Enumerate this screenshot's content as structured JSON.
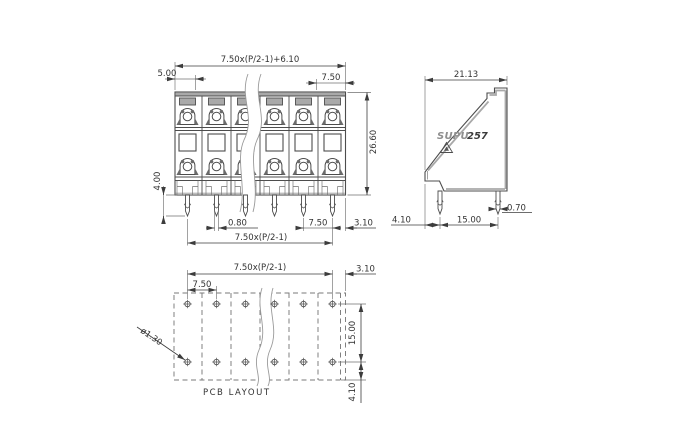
{
  "front_view": {
    "dim_total_width": "7.50x(P/2-1)+6.10",
    "dim_end_width": "5.00",
    "dim_unit_pitch": "7.50",
    "dim_height": "26.60",
    "dim_pin_length": "4.00",
    "dim_pin_width": "0.80",
    "dim_pin_pitch": "7.50",
    "dim_pin_edge_offset": "3.10",
    "dim_pin_span": "7.50x(P/2-1)"
  },
  "side_view": {
    "dim_depth": "21.13",
    "brand_text": "SUPU",
    "model_text": "257",
    "dim_pin_edge_offset": "4.10",
    "dim_pin_row_spacing": "15.00",
    "dim_pin_width": "0.70"
  },
  "pcb_layout": {
    "dim_hole_span": "7.50x(P/2-1)",
    "dim_edge_offset": "3.10",
    "dim_hole_pitch": "7.50",
    "dim_row_spacing": "15.00",
    "dim_bottom_offset": "4.10",
    "dim_hole_diameter": "ø1.30",
    "caption": "PCB LAYOUT"
  },
  "colors": {
    "outline": "#4d4d4d",
    "dimension": "#3c3c3c",
    "shading": "#a9a9a9"
  }
}
